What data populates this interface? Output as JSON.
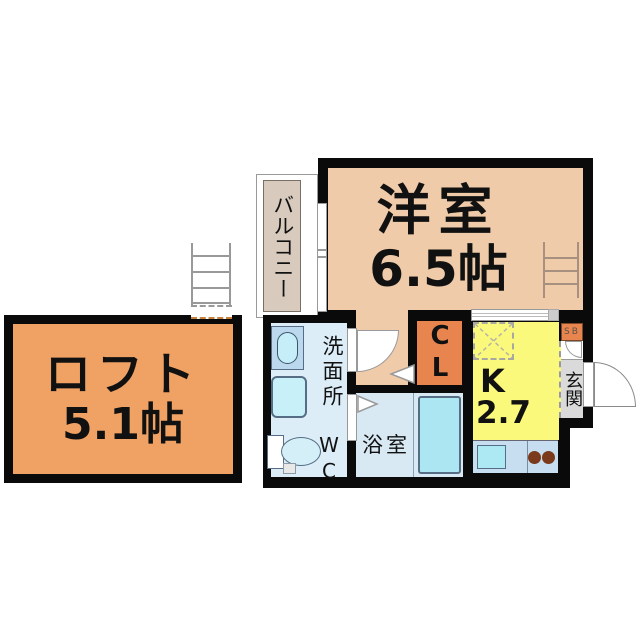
{
  "plan_title": "1K apartment floor plan",
  "rooms": {
    "loft": {
      "name": "ロフト",
      "size": "5.1帖"
    },
    "western": {
      "name": "洋室",
      "size": "6.5帖"
    },
    "balcony": {
      "name": "バルコニー"
    },
    "washroom": {
      "name": "洗面所",
      "toilet_label": "WC"
    },
    "bathroom": {
      "name": "浴室"
    },
    "closet": {
      "label": "CL"
    },
    "kitchen": {
      "label": "K",
      "size": "2.7帖"
    },
    "entrance": {
      "name": "玄関",
      "shoebox_label": "SB"
    }
  },
  "colors": {
    "wall": "#0a0a0a",
    "loft_fill": "#f0a264",
    "closet_fill": "#e8854f",
    "western_fill": "#efcba9",
    "balcony_fill": "#d8cabd",
    "washroom_fill": "#dcedf8",
    "bathroom_fill": "#d8e9f4",
    "bathtub_fill": "#abe6f2",
    "kitchen_fill": "#fbf97b",
    "counter_fill": "#c6def0",
    "entrance_fill": "#dadada",
    "burner_fill": "#7b3a1c"
  }
}
